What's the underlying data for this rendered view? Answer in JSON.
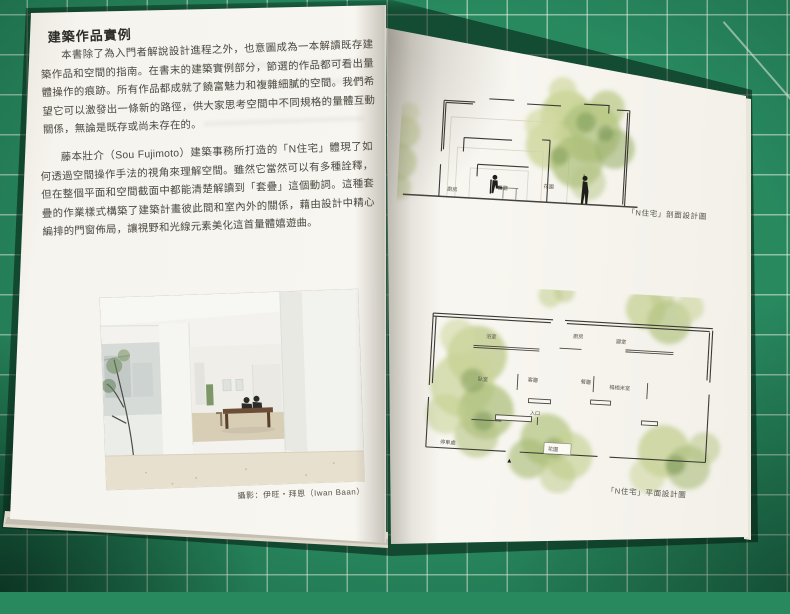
{
  "left_page": {
    "heading": "建築作品實例",
    "paragraph1": "本書除了為入門者解說設計進程之外，也意圖成為一本解讀既存建築作品和空間的指南。在書末的建築實例部分，節選的作品都可看出量體操作的痕跡。所有作品都成就了饒富魅力和複雜細膩的空間。我們希望它可以激發出一條新的路徑，供大家思考空間中不同規格的量體互動關係，無論是既存或尚未存在的。",
    "paragraph2": "藤本壯介（Sou Fujimoto）建築事務所打造的「N住宅」體現了如何透過空間操作手法的視角來理解空間。雖然它當然可以有多種詮釋，但在整個平面和空間截面中都能清楚解讀到「套疊」這個動詞。這種套疊的作業樣式構築了建築計畫彼此間和室內外的關係，藉由設計中精心編排的門窗佈局，讓視野和光線元素美化這首量體嬉遊曲。",
    "photo_caption": "攝影：伊旺・拜恩（Iwan Baan）",
    "page_number": "12"
  },
  "right_page": {
    "section_drawing": {
      "caption": "「N住宅」剖面設計圖",
      "labels": [
        "廚房",
        "餐廳",
        "花園"
      ]
    },
    "plan_drawing": {
      "caption": "「N住宅」平面設計圖",
      "labels": [
        "浴室",
        "廚房",
        "寢室",
        "臥室",
        "客廳",
        "餐廳",
        "榻榻米室",
        "入口",
        "停車處",
        "花園"
      ],
      "entrance_marker": "▲"
    }
  },
  "colors": {
    "mat_green": "#28895f",
    "page": "#f6f4ee",
    "ink": "#45433c",
    "tree_light": "#ccd591",
    "tree_dark": "#7d9a58"
  }
}
